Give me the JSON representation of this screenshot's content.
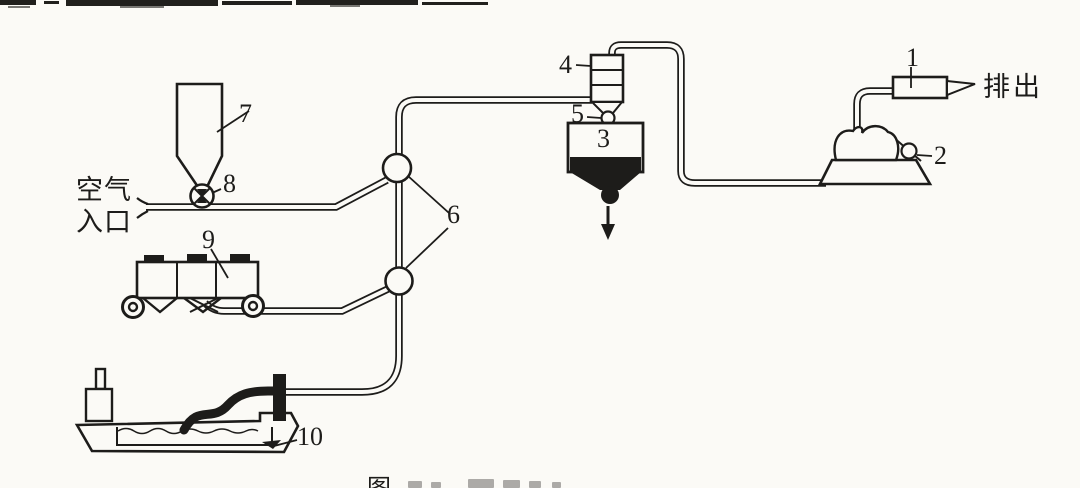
{
  "figure": {
    "callouts": {
      "1": "1",
      "2": "2",
      "3": "3",
      "4": "4",
      "5": "5",
      "6": "6",
      "7": "7",
      "8": "8",
      "9": "9",
      "10": "10"
    },
    "labels": {
      "air_inlet_line1": "空气",
      "air_inlet_line2": "入口",
      "discharge": "排出",
      "caption_fragment": "图"
    },
    "colors": {
      "ink": "#1d1c1a",
      "paper": "#fbfaf6"
    }
  }
}
